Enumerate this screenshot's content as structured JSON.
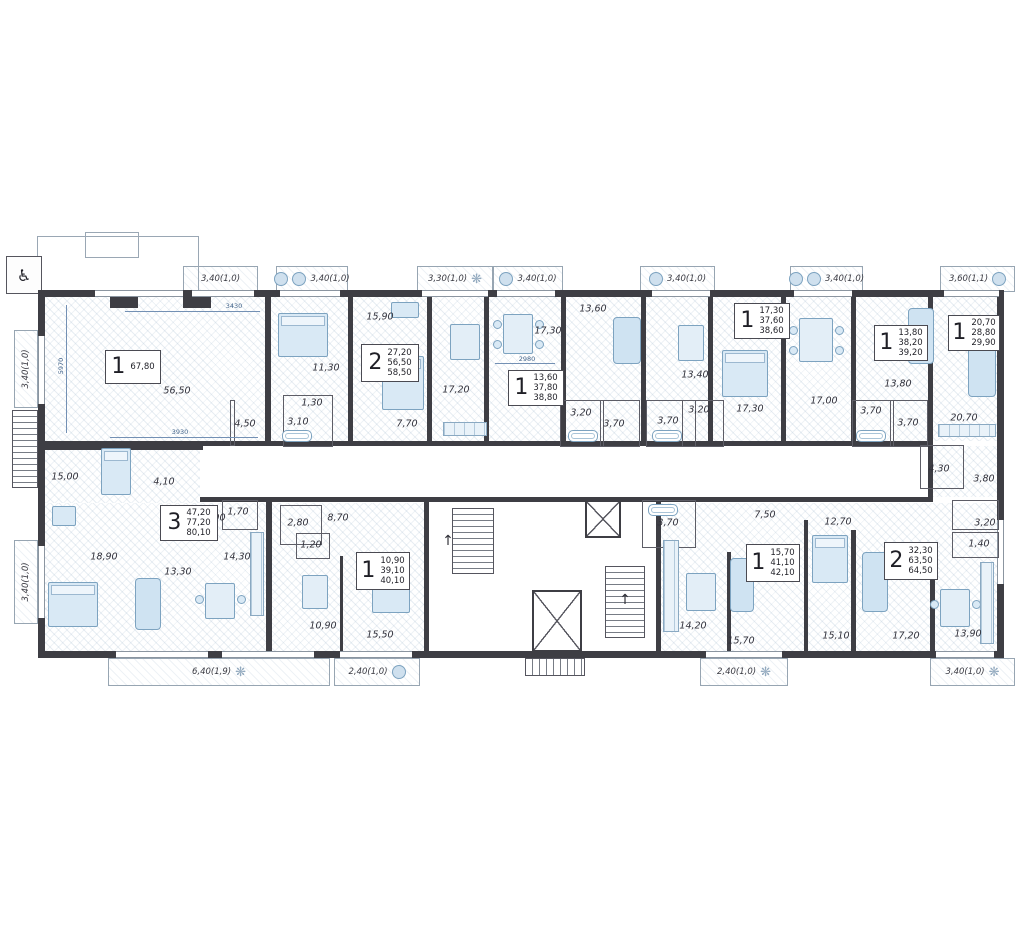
{
  "units": [
    {
      "type": "1",
      "areas": [
        "67,80"
      ]
    },
    {
      "type": "2",
      "areas": [
        "27,20",
        "56,50",
        "58,50"
      ]
    },
    {
      "type": "1",
      "areas": [
        "13,60",
        "37,80",
        "38,80"
      ]
    },
    {
      "type": "1",
      "areas": [
        "17,30",
        "37,60",
        "38,60"
      ]
    },
    {
      "type": "1",
      "areas": [
        "13,80",
        "38,20",
        "39,20"
      ]
    },
    {
      "type": "1",
      "areas": [
        "20,70",
        "28,80",
        "29,90"
      ]
    },
    {
      "type": "3",
      "areas": [
        "47,20",
        "77,20",
        "80,10"
      ]
    },
    {
      "type": "1",
      "areas": [
        "10,90",
        "39,10",
        "40,10"
      ]
    },
    {
      "type": "1",
      "areas": [
        "15,70",
        "41,10",
        "42,10"
      ]
    },
    {
      "type": "2",
      "areas": [
        "32,30",
        "63,50",
        "64,50"
      ]
    }
  ],
  "room_labels": [
    "56,50",
    "4,50",
    "15,90",
    "11,30",
    "1,30",
    "3,10",
    "7,70",
    "17,20",
    "17,30",
    "13,60",
    "3,20",
    "3,70",
    "3,70",
    "13,40",
    "3,20",
    "17,30",
    "17,00",
    "13,80",
    "3,70",
    "3,70",
    "20,70",
    "4,30",
    "3,80",
    "15,00",
    "4,10",
    "9,90",
    "1,70",
    "18,90",
    "13,30",
    "14,30",
    "2,80",
    "8,70",
    "1,20",
    "10,90",
    "15,50",
    "3,70",
    "7,50",
    "14,20",
    "15,70",
    "12,70",
    "15,10",
    "17,20",
    "13,90",
    "3,20",
    "1,40"
  ],
  "balconies": {
    "top": [
      "3,40(1,0)",
      "3,40(1,0)",
      "3,30(1,0)",
      "3,40(1,0)",
      "3,40(1,0)",
      "3,40(1,0)",
      "3,60(1,1)"
    ],
    "bottom": [
      "6,40(1,9)",
      "2,40(1,0)",
      "2,40(1,0)",
      "3,40(1,0)"
    ],
    "left": [
      "3,40(1,0)",
      "3,40(1,0)"
    ]
  },
  "dimensions": [
    "3430",
    "3930",
    "2980",
    "5970"
  ],
  "icons": {
    "wheelchair": "♿",
    "stair_arrow": "↑"
  },
  "colors": {
    "wall": "#3e3e44",
    "furniture_fill": "#d9e9f5",
    "furniture_stroke": "#7da3c0",
    "dimension": "#41638a"
  }
}
